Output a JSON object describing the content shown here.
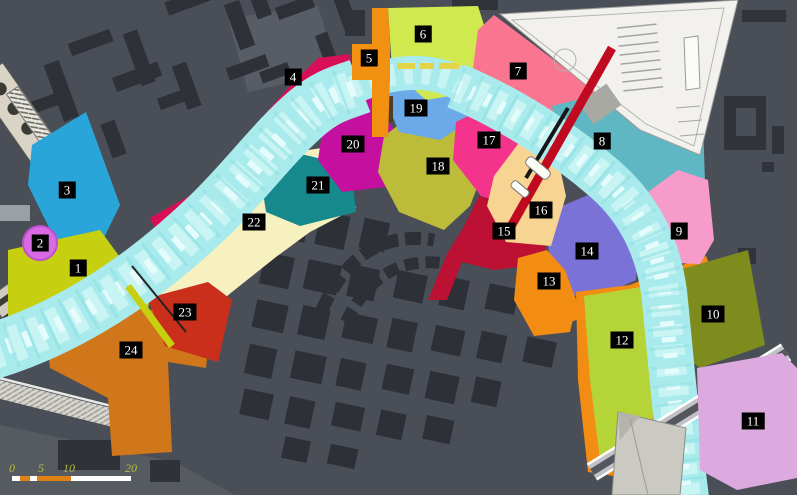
{
  "map": {
    "background_color": "#4a4e57",
    "water_color": "#a9ebed",
    "zones": [
      {
        "number": "1",
        "color": "#c6cf10"
      },
      {
        "number": "2",
        "color": "#d96ae4"
      },
      {
        "number": "3",
        "color": "#2aa5d9"
      },
      {
        "number": "4",
        "color": "#d80f56"
      },
      {
        "number": "5",
        "color": "#f29111"
      },
      {
        "number": "6",
        "color": "#cfe94e"
      },
      {
        "number": "7",
        "color": "#fa7590"
      },
      {
        "number": "8",
        "color": "#5fb7c3"
      },
      {
        "number": "9",
        "color": "#f79bcb"
      },
      {
        "number": "10",
        "color": "#7e8c1e"
      },
      {
        "number": "11",
        "color": "#dcaade"
      },
      {
        "number": "12",
        "color": "#b5d438"
      },
      {
        "number": "13",
        "color": "#f28c12"
      },
      {
        "number": "14",
        "color": "#7b72d8"
      },
      {
        "number": "15",
        "color": "#bc1133"
      },
      {
        "number": "16",
        "color": "#f8d493"
      },
      {
        "number": "17",
        "color": "#f3338c"
      },
      {
        "number": "18",
        "color": "#bcbb3a"
      },
      {
        "number": "19",
        "color": "#6ba9e8"
      },
      {
        "number": "20",
        "color": "#c50f9e"
      },
      {
        "number": "21",
        "color": "#15898c"
      },
      {
        "number": "22",
        "color": "#f7f0bf"
      },
      {
        "number": "23",
        "color": "#c92f1b"
      },
      {
        "number": "24",
        "color": "#d0761b"
      }
    ],
    "structures": {
      "red_bridge_color": "#c00a20",
      "site_plan_color": "#f2f1ee",
      "road_bridge_color": "#c2c2c6",
      "dock_color": "#cac9c2"
    },
    "scale_bar": {
      "labels": [
        "0",
        "5",
        "10",
        "20"
      ],
      "label_color": "#b3bd41",
      "bar_colors": {
        "white": "#ffffff",
        "orange": "#df8112"
      }
    }
  }
}
